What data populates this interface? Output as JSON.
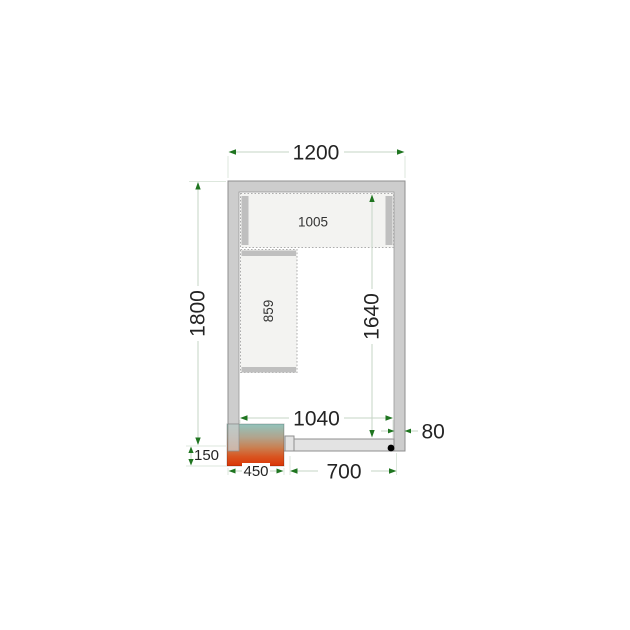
{
  "title": "cold-room-floor-plan",
  "labels": {
    "outer_width": "1200",
    "outer_depth": "1800",
    "inner_depth": "1640",
    "inner_width": "1040",
    "wall_thickness": "80",
    "door_width": "700",
    "unit_width": "450",
    "unit_protrusion": "150",
    "shelf_top_length": "1005",
    "shelf_side_length": "859"
  },
  "colors": {
    "wall_fill": "#cdcdcd",
    "wall_stroke": "#8f8f8f",
    "interior_fill": "#ffffff",
    "shelf_fill": "#f3f3f1",
    "shelf_bar": "#bfbfbf",
    "door_fill": "#e3e3e3",
    "dim_line": "#c6d4c6",
    "ext_line": "#dde7dd",
    "arrow": "#1f7520",
    "text": "#242424",
    "hinge_dot": "#000000",
    "unit_gradient": [
      "#92c4bc",
      "#b2a38c",
      "#c98052",
      "#d95420",
      "#da3506"
    ]
  }
}
